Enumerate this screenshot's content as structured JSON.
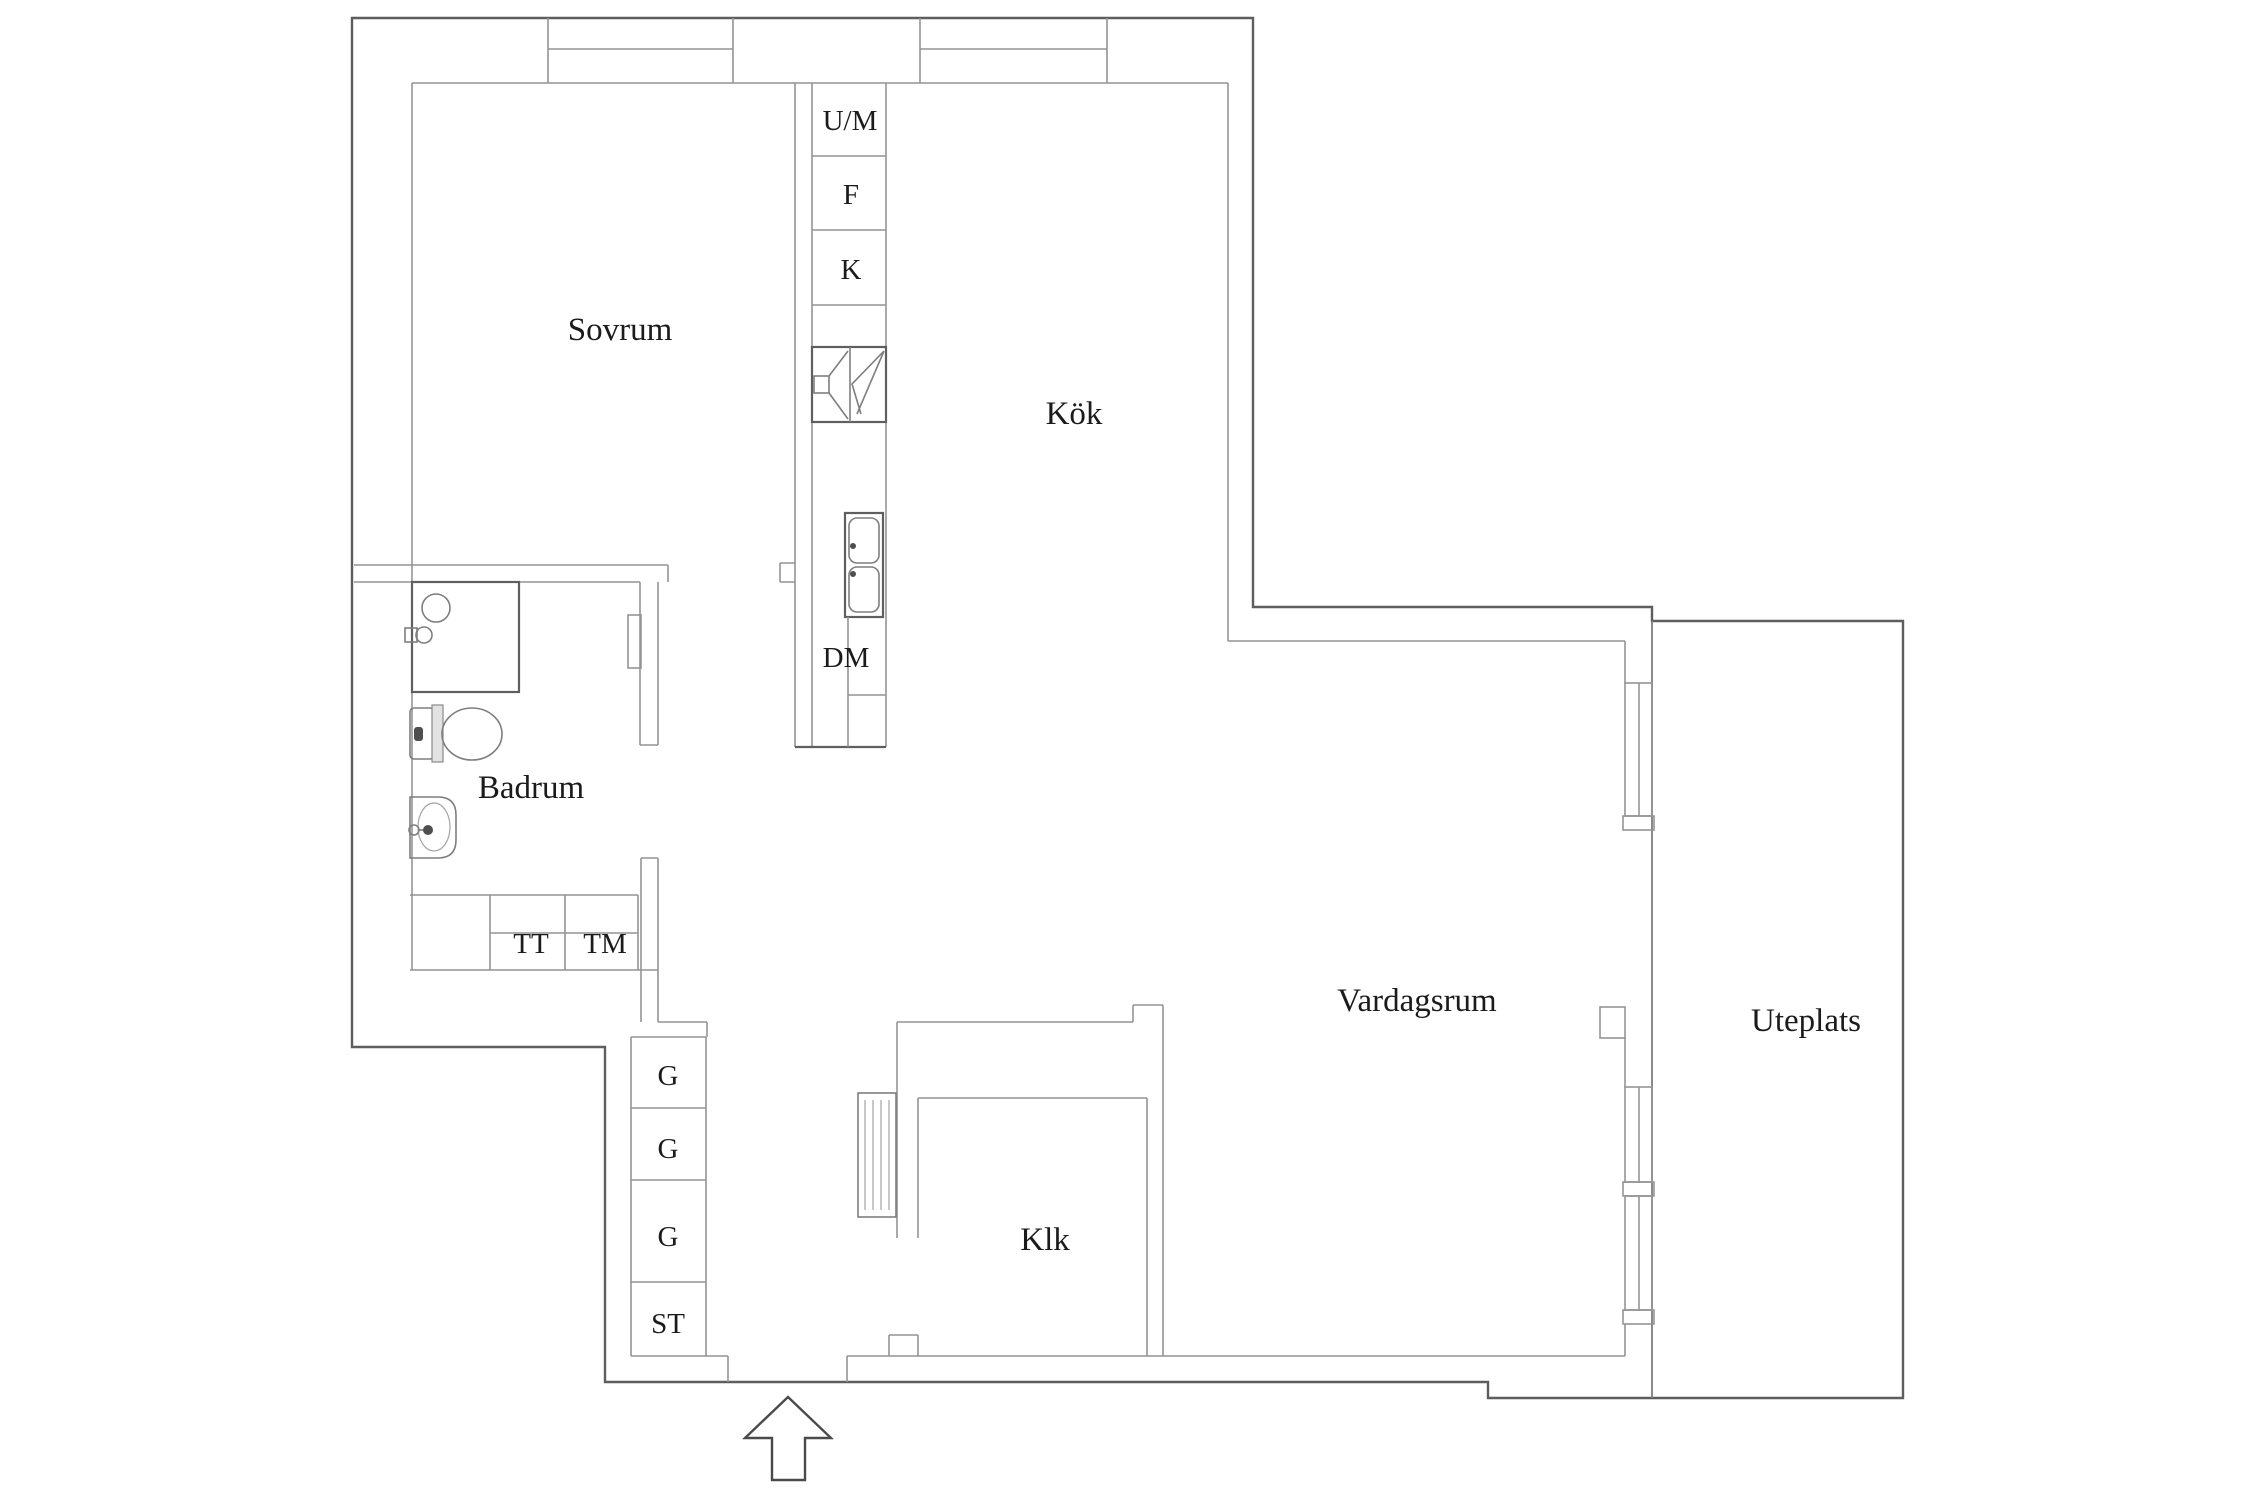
{
  "document": {
    "type": "apartment floor plan",
    "language": "Swedish"
  },
  "colors": {
    "background": "#ffffff",
    "wall_outer": "#5e5e5e",
    "wall_inner": "#949494",
    "text": "#1b1b1b"
  },
  "labels": {
    "sovrum": "Sovrum",
    "kok": "Kök",
    "badrum": "Badrum",
    "vardagsrum": "Vardagsrum",
    "uteplats": "Uteplats",
    "klk": "Klk",
    "um": "U/M",
    "f": "F",
    "k": "K",
    "dm": "DM",
    "tt": "TT",
    "tm": "TM",
    "g1": "G",
    "g2": "G",
    "g3": "G",
    "st": "ST"
  },
  "fixtures": [
    "shower",
    "shower-valve",
    "toilet",
    "washbasin",
    "stove-fan",
    "double-sink",
    "radiator",
    "wall-windows",
    "entrance-arrow"
  ]
}
